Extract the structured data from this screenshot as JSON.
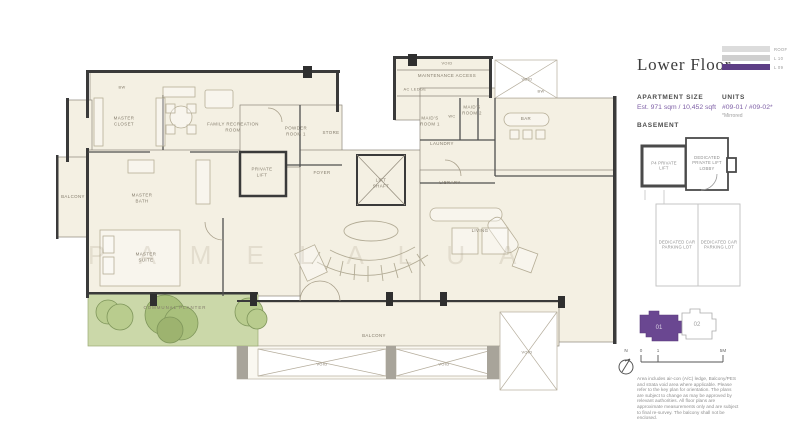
{
  "panel": {
    "title": "Lower Floor",
    "level_indicator": {
      "levels": [
        {
          "label": "ROOF",
          "active": false
        },
        {
          "label": "L 10",
          "active": false
        },
        {
          "label": "L 09",
          "active": true
        }
      ]
    },
    "apartment_size": {
      "label": "APARTMENT SIZE",
      "value": "Est. 971 sqm / 10,452 sqft"
    },
    "units": {
      "label": "UNITS",
      "value": "#09-01 / #09-02*",
      "note": "*Mirrored"
    },
    "basement": {
      "label": "BASEMENT",
      "rooms": [
        {
          "label": "P4 PRIVATE LIFT"
        },
        {
          "label": "DEDICATED PRIVATE LIFT LOBBY"
        },
        {
          "label": "DEDICATED CAR PARKING LOT"
        },
        {
          "label": "DEDICATED CAR PARKING LOT"
        }
      ]
    },
    "key_plan": {
      "unit1": "01",
      "unit2": "02"
    },
    "compass_label": "N",
    "scale": {
      "ticks": [
        "0",
        "1",
        "5M"
      ]
    },
    "disclaimer": "Area includes air-con (A/C) ledge, Balcony/PES and strata void area where applicable. Please refer to the key plan for orientation. The plans are subject to change as may be approved by relevant authorities. All floor plans are approximate measurements only and are subject to final re-survey. The balcony shall not be enclosed."
  },
  "colors": {
    "accent_purple": "#5d3e85",
    "plan_cream": "#f4f0e3",
    "planter_green": "#cbd8a9"
  },
  "plan": {
    "watermark": "P A M E L A  L U A",
    "rooms": [
      {
        "label": "BW"
      },
      {
        "label": "MASTER CLOSET"
      },
      {
        "label": "FAMILY RECREATION ROOM"
      },
      {
        "label": "BALCONY"
      },
      {
        "label": "MASTER BATH"
      },
      {
        "label": "POWDER ROOM 1"
      },
      {
        "label": "STORE"
      },
      {
        "label": "PRIVATE LIFT"
      },
      {
        "label": "FOYER"
      },
      {
        "label": "LIFT SHAFT"
      },
      {
        "label": "LIBRARY"
      },
      {
        "label": "VOID"
      },
      {
        "label": "MAINTENANCE ACCESS"
      },
      {
        "label": "AC LEDGE"
      },
      {
        "label": "MAID'S ROOM 1"
      },
      {
        "label": "WC"
      },
      {
        "label": "MAID'S ROOM 2"
      },
      {
        "label": "LAUNDRY"
      },
      {
        "label": "BAR"
      },
      {
        "label": "BW"
      },
      {
        "label": "LIVING"
      },
      {
        "label": "MASTER SUITE"
      },
      {
        "label": "COMMUNAL PLANTER"
      },
      {
        "label": "BALCONY"
      },
      {
        "label": "VOID"
      },
      {
        "label": "VOID"
      },
      {
        "label": "VOID"
      },
      {
        "label": "VOID"
      }
    ]
  }
}
